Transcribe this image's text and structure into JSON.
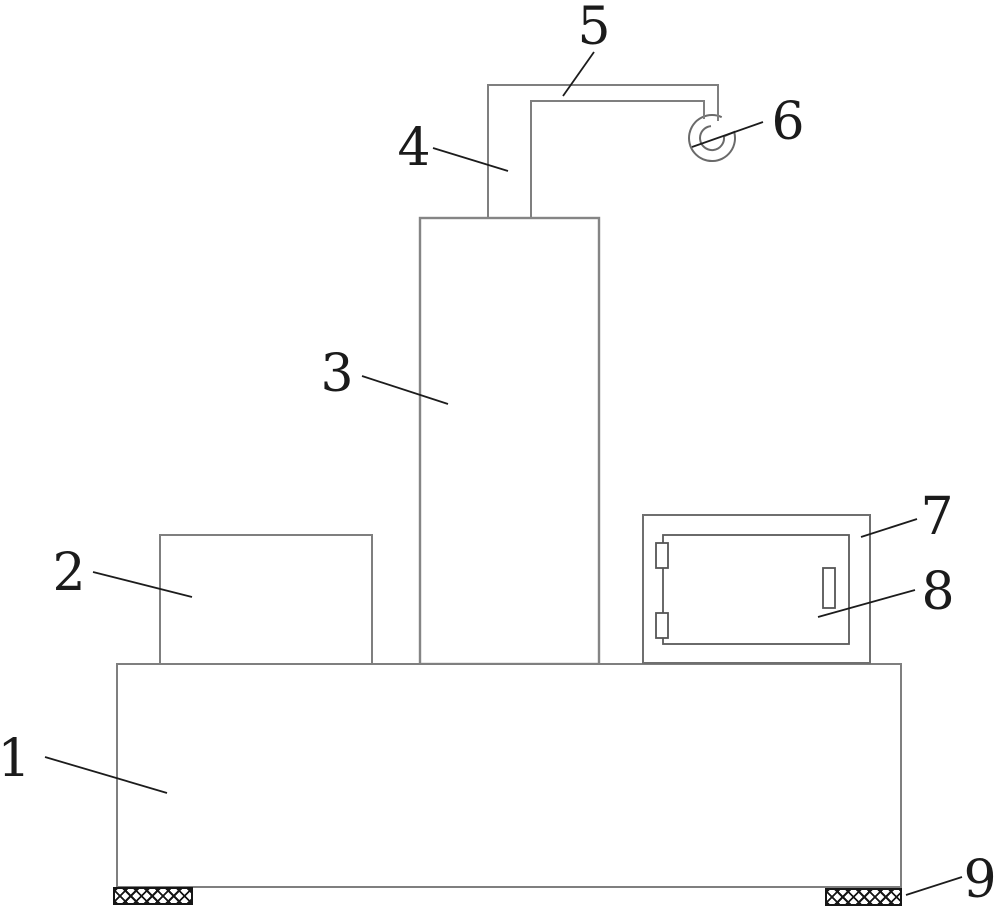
{
  "figure": {
    "kind": "patent-technical-drawing",
    "background_color": "#ffffff",
    "outline_color": "#7f7f7f",
    "cabinet_outline_color": "#5a5a5a",
    "annotation_color": "#1b1b1b",
    "hatch_color": "#161616"
  },
  "part_labels": [
    {
      "number": "1"
    },
    {
      "number": "2"
    },
    {
      "number": "3"
    },
    {
      "number": "4"
    },
    {
      "number": "5"
    },
    {
      "number": "6"
    },
    {
      "number": "7"
    },
    {
      "number": "8"
    },
    {
      "number": "9"
    }
  ]
}
